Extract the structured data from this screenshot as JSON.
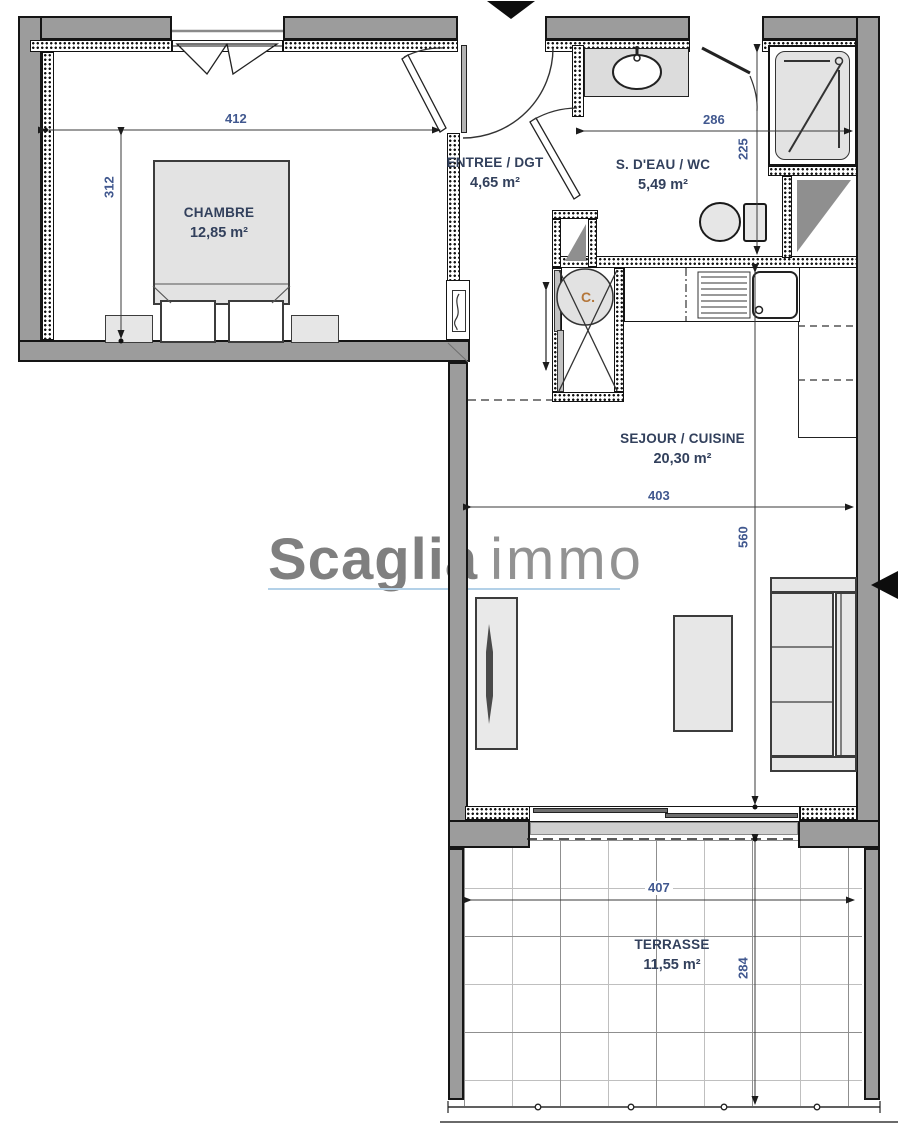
{
  "watermark": {
    "brand_primary": "Scaglia",
    "brand_secondary": "immo"
  },
  "rooms": [
    {
      "name": "CHAMBRE",
      "area": "12,85 m²"
    },
    {
      "name": "ENTREE / DGT",
      "area": "4,65 m²"
    },
    {
      "name": "S. D'EAU / WC",
      "area": "5,49 m²"
    },
    {
      "name": "SEJOUR / CUISINE",
      "area": "20,30 m²"
    },
    {
      "name": "TERRASSE",
      "area": "11,55 m²"
    }
  ],
  "dimensions_cm": {
    "bedroom_width": "412",
    "bedroom_depth": "312",
    "bathroom_width": "286",
    "bathroom_depth": "225",
    "living_width": "403",
    "living_depth": "560",
    "terrace_width": "407",
    "terrace_depth": "284"
  },
  "labels": {
    "closet": "C."
  },
  "colors": {
    "wall_fill": "#9c9c9c",
    "dimension_text": "#41588f",
    "room_text": "#32405c",
    "watermark_gray": "#7f7f7f",
    "underline_blue": "#b3d1e8"
  }
}
